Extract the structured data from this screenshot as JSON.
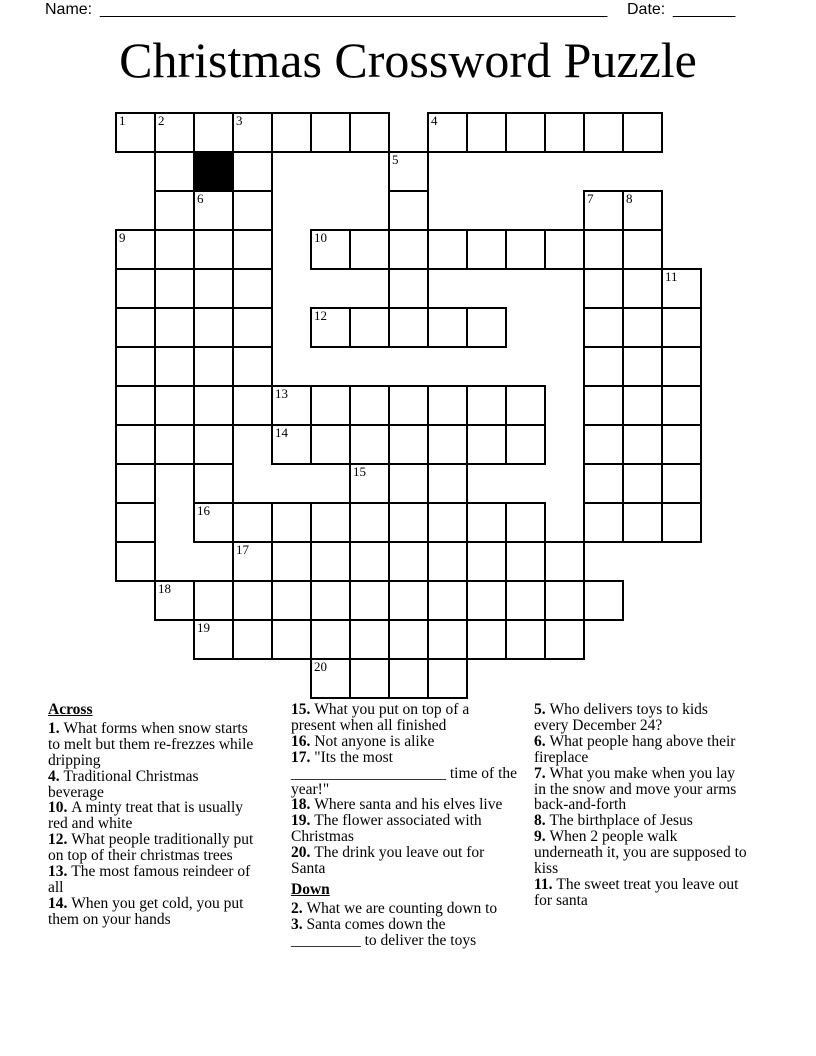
{
  "header": {
    "name_label": "Name:",
    "name_blank": "_________________________________________________________",
    "date_label": "Date:",
    "date_blank": "_______"
  },
  "title": "Christmas Crossword Puzzle",
  "grid": {
    "rows": 15,
    "cols": 15,
    "cell_px": 39,
    "cells": [
      [
        0,
        0,
        "1"
      ],
      [
        0,
        1,
        "2"
      ],
      [
        0,
        2,
        ""
      ],
      [
        0,
        3,
        "3"
      ],
      [
        0,
        4,
        ""
      ],
      [
        0,
        5,
        ""
      ],
      [
        0,
        6,
        ""
      ],
      [
        0,
        8,
        "4"
      ],
      [
        0,
        9,
        ""
      ],
      [
        0,
        10,
        ""
      ],
      [
        0,
        11,
        ""
      ],
      [
        0,
        12,
        ""
      ],
      [
        0,
        13,
        ""
      ],
      [
        1,
        1,
        ""
      ],
      [
        1,
        2,
        "",
        true
      ],
      [
        1,
        3,
        ""
      ],
      [
        1,
        7,
        "5"
      ],
      [
        2,
        1,
        ""
      ],
      [
        2,
        2,
        "6"
      ],
      [
        2,
        3,
        ""
      ],
      [
        2,
        7,
        ""
      ],
      [
        2,
        12,
        "7"
      ],
      [
        2,
        13,
        "8"
      ],
      [
        3,
        0,
        "9"
      ],
      [
        3,
        1,
        ""
      ],
      [
        3,
        2,
        ""
      ],
      [
        3,
        3,
        ""
      ],
      [
        3,
        5,
        "10"
      ],
      [
        3,
        6,
        ""
      ],
      [
        3,
        7,
        ""
      ],
      [
        3,
        8,
        ""
      ],
      [
        3,
        9,
        ""
      ],
      [
        3,
        10,
        ""
      ],
      [
        3,
        11,
        ""
      ],
      [
        3,
        12,
        ""
      ],
      [
        3,
        13,
        ""
      ],
      [
        4,
        0,
        ""
      ],
      [
        4,
        1,
        ""
      ],
      [
        4,
        2,
        ""
      ],
      [
        4,
        3,
        ""
      ],
      [
        4,
        7,
        ""
      ],
      [
        4,
        12,
        ""
      ],
      [
        4,
        13,
        ""
      ],
      [
        4,
        14,
        "11"
      ],
      [
        5,
        0,
        ""
      ],
      [
        5,
        1,
        ""
      ],
      [
        5,
        2,
        ""
      ],
      [
        5,
        3,
        ""
      ],
      [
        5,
        5,
        "12"
      ],
      [
        5,
        6,
        ""
      ],
      [
        5,
        7,
        ""
      ],
      [
        5,
        8,
        ""
      ],
      [
        5,
        9,
        ""
      ],
      [
        5,
        12,
        ""
      ],
      [
        5,
        13,
        ""
      ],
      [
        5,
        14,
        ""
      ],
      [
        6,
        0,
        ""
      ],
      [
        6,
        1,
        ""
      ],
      [
        6,
        2,
        ""
      ],
      [
        6,
        3,
        ""
      ],
      [
        6,
        12,
        ""
      ],
      [
        6,
        13,
        ""
      ],
      [
        6,
        14,
        ""
      ],
      [
        7,
        0,
        ""
      ],
      [
        7,
        1,
        ""
      ],
      [
        7,
        2,
        ""
      ],
      [
        7,
        3,
        ""
      ],
      [
        7,
        4,
        "13"
      ],
      [
        7,
        5,
        ""
      ],
      [
        7,
        6,
        ""
      ],
      [
        7,
        7,
        ""
      ],
      [
        7,
        8,
        ""
      ],
      [
        7,
        9,
        ""
      ],
      [
        7,
        10,
        ""
      ],
      [
        7,
        12,
        ""
      ],
      [
        7,
        13,
        ""
      ],
      [
        7,
        14,
        ""
      ],
      [
        8,
        0,
        ""
      ],
      [
        8,
        1,
        ""
      ],
      [
        8,
        2,
        ""
      ],
      [
        8,
        4,
        "14"
      ],
      [
        8,
        5,
        ""
      ],
      [
        8,
        6,
        ""
      ],
      [
        8,
        7,
        ""
      ],
      [
        8,
        8,
        ""
      ],
      [
        8,
        9,
        ""
      ],
      [
        8,
        10,
        ""
      ],
      [
        8,
        12,
        ""
      ],
      [
        8,
        13,
        ""
      ],
      [
        8,
        14,
        ""
      ],
      [
        9,
        0,
        ""
      ],
      [
        9,
        2,
        ""
      ],
      [
        9,
        6,
        "15"
      ],
      [
        9,
        7,
        ""
      ],
      [
        9,
        8,
        ""
      ],
      [
        9,
        12,
        ""
      ],
      [
        9,
        13,
        ""
      ],
      [
        9,
        14,
        ""
      ],
      [
        10,
        0,
        ""
      ],
      [
        10,
        2,
        "16"
      ],
      [
        10,
        3,
        ""
      ],
      [
        10,
        4,
        ""
      ],
      [
        10,
        5,
        ""
      ],
      [
        10,
        6,
        ""
      ],
      [
        10,
        7,
        ""
      ],
      [
        10,
        8,
        ""
      ],
      [
        10,
        9,
        ""
      ],
      [
        10,
        10,
        ""
      ],
      [
        10,
        12,
        ""
      ],
      [
        10,
        13,
        ""
      ],
      [
        10,
        14,
        ""
      ],
      [
        11,
        0,
        ""
      ],
      [
        11,
        3,
        "17"
      ],
      [
        11,
        4,
        ""
      ],
      [
        11,
        5,
        ""
      ],
      [
        11,
        6,
        ""
      ],
      [
        11,
        7,
        ""
      ],
      [
        11,
        8,
        ""
      ],
      [
        11,
        9,
        ""
      ],
      [
        11,
        10,
        ""
      ],
      [
        11,
        11,
        ""
      ],
      [
        12,
        1,
        "18"
      ],
      [
        12,
        2,
        ""
      ],
      [
        12,
        3,
        ""
      ],
      [
        12,
        4,
        ""
      ],
      [
        12,
        5,
        ""
      ],
      [
        12,
        6,
        ""
      ],
      [
        12,
        7,
        ""
      ],
      [
        12,
        8,
        ""
      ],
      [
        12,
        9,
        ""
      ],
      [
        12,
        10,
        ""
      ],
      [
        12,
        11,
        ""
      ],
      [
        12,
        12,
        ""
      ],
      [
        13,
        2,
        "19"
      ],
      [
        13,
        3,
        ""
      ],
      [
        13,
        4,
        ""
      ],
      [
        13,
        5,
        ""
      ],
      [
        13,
        6,
        ""
      ],
      [
        13,
        7,
        ""
      ],
      [
        13,
        8,
        ""
      ],
      [
        13,
        9,
        ""
      ],
      [
        13,
        10,
        ""
      ],
      [
        13,
        11,
        ""
      ],
      [
        14,
        5,
        "20"
      ],
      [
        14,
        6,
        ""
      ],
      [
        14,
        7,
        ""
      ],
      [
        14,
        8,
        ""
      ]
    ]
  },
  "clues": {
    "across_label": "Across",
    "down_label": "Down",
    "across": [
      {
        "num": "1",
        "text": "What forms when snow starts\nto melt but them re-frezzes while\ndripping"
      },
      {
        "num": "4",
        "text": "Traditional Christmas\nbeverage"
      },
      {
        "num": "10",
        "text": "A minty treat that is usually\nred and white"
      },
      {
        "num": "12",
        "text": "What people traditionally put\non top of their christmas trees"
      },
      {
        "num": "13",
        "text": "The most famous reindeer of\nall"
      },
      {
        "num": "14",
        "text": "When you get cold, you put\nthem on your hands"
      },
      {
        "num": "15",
        "text": "What you put on top of a\npresent when all finished"
      },
      {
        "num": "16",
        "text": "Not anyone is alike"
      },
      {
        "num": "17",
        "text": "\"Its the most\n____________________ time of the\nyear!\""
      },
      {
        "num": "18",
        "text": "Where santa and his elves live"
      },
      {
        "num": "19",
        "text": "The flower associated with\nChristmas"
      },
      {
        "num": "20",
        "text": "The drink you leave out for\nSanta"
      }
    ],
    "down": [
      {
        "num": "2",
        "text": "What we are counting down to"
      },
      {
        "num": "3",
        "text": "Santa comes down the\n_________ to deliver the toys"
      },
      {
        "num": "5",
        "text": "Who delivers toys to kids\nevery December 24?"
      },
      {
        "num": "6",
        "text": "What people hang above their\nfireplace"
      },
      {
        "num": "7",
        "text": "What you make when you lay\nin the snow and move your arms\nback-and-forth"
      },
      {
        "num": "8",
        "text": "The birthplace of Jesus"
      },
      {
        "num": "9",
        "text": "When 2 people walk\nunderneath it, you are supposed to\nkiss"
      },
      {
        "num": "11",
        "text": "The sweet treat you leave out\nfor santa"
      }
    ]
  }
}
